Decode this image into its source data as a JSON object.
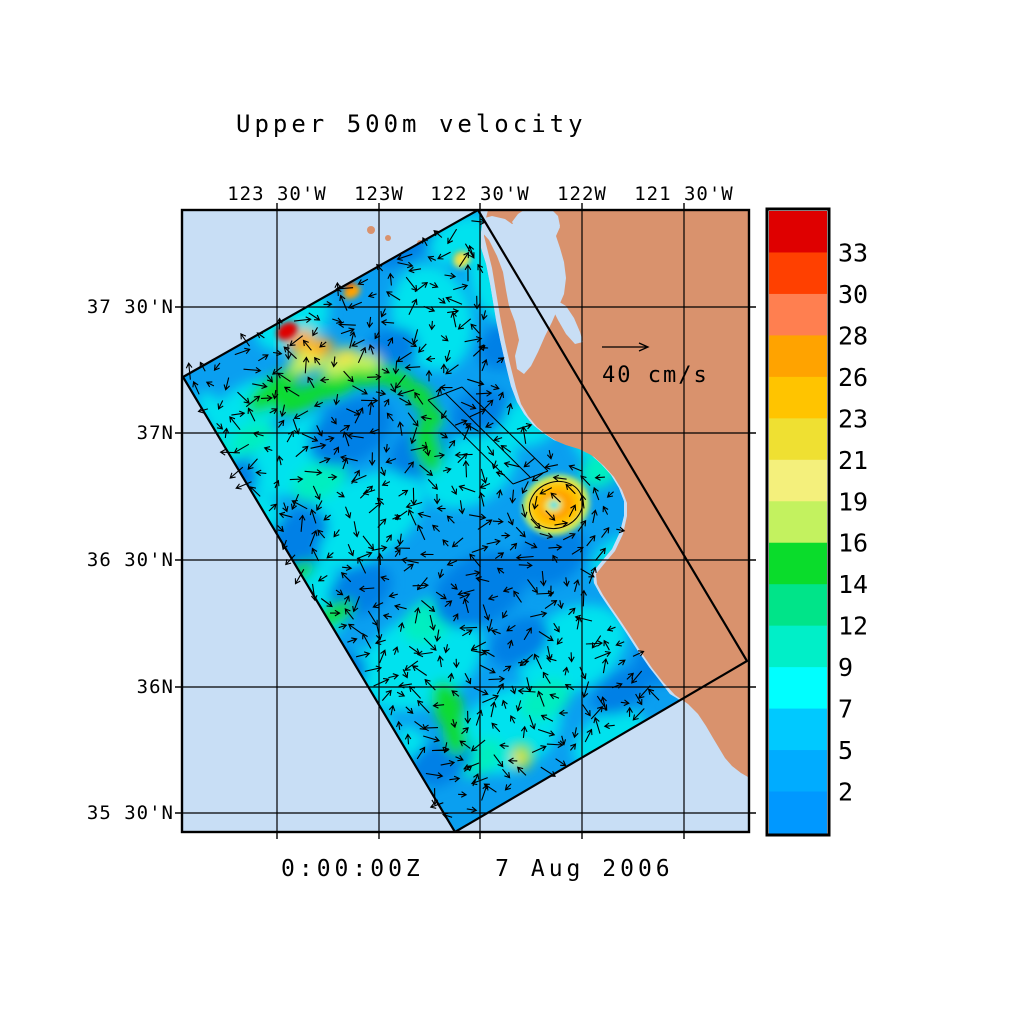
{
  "title": "Upper 500m velocity",
  "timestamp": "0:00:00Z    7 Aug 2006",
  "reference_vector": {
    "label": "40 cm/s"
  },
  "axis": {
    "top_labels": [
      {
        "text": "123 30'W",
        "x": 277
      },
      {
        "text": "123W",
        "x": 379
      },
      {
        "text": "122 30'W",
        "x": 480
      },
      {
        "text": "122W",
        "x": 582
      },
      {
        "text": "121 30'W",
        "x": 684
      }
    ],
    "left_labels": [
      {
        "text": "37 30'N",
        "y": 307
      },
      {
        "text": "37N",
        "y": 433
      },
      {
        "text": "36 30'N",
        "y": 560
      },
      {
        "text": "36N",
        "y": 687
      },
      {
        "text": "35 30'N",
        "y": 813
      }
    ]
  },
  "colorbar": {
    "labels_top_to_bottom": [
      "33",
      "30",
      "28",
      "26",
      "23",
      "21",
      "19",
      "16",
      "14",
      "12",
      "9",
      "7",
      "5",
      "2"
    ],
    "colors_top_to_bottom": [
      "#DF0000",
      "#FF4000",
      "#FF7F50",
      "#FFA300",
      "#FFC400",
      "#EFE032",
      "#F4F07C",
      "#C3F25F",
      "#0ADC2B",
      "#00E489",
      "#00EFC8",
      "#00FFFF",
      "#00C9FF",
      "#00ACFF",
      "#0098FF"
    ]
  },
  "palette": {
    "ocean": "#C8DEF5",
    "land": "#D9926D",
    "base": "#0A9FF0",
    "ink": "#000000",
    "b": "#0080E6",
    "c": "#00E2EE",
    "t": "#00EFC0",
    "g": "#0ADC32",
    "lg": "#C3F25F",
    "y": "#EFE44A",
    "am": "#FFC400",
    "o": "#FFA300",
    "r": "#E00000"
  },
  "chart_data": {
    "type": "heatmap",
    "title": "Upper 500m velocity",
    "datetime": "0:00:00Z 7 Aug 2006",
    "units": "cm/s",
    "x_ticks": [
      "123 30'W",
      "123W",
      "122 30'W",
      "122W",
      "121 30'W"
    ],
    "y_ticks": [
      "37 30'N",
      "37N",
      "36 30'N",
      "36N",
      "35 30'N"
    ],
    "x_range_deg_west": [
      123.97,
      121.18
    ],
    "y_range_deg_north": [
      35.43,
      37.88
    ],
    "colorbar_boundaries_cm_s": [
      2,
      5,
      7,
      9,
      12,
      14,
      16,
      19,
      21,
      23,
      26,
      28,
      30,
      33
    ],
    "reference_vector_cm_s": 40,
    "legend_position": "right",
    "grid": true,
    "features": [
      {
        "name": "model-domain",
        "shape": "rotated rectangle outlined in black, tilted ~30 deg, spanning the coastal ocean"
      },
      {
        "name": "high-speed-jet",
        "location": "northwest corner of domain near 123.5W 37.3N",
        "max_cm_s": 33
      },
      {
        "name": "coastal-eddy",
        "location": "off Monterey Bay near 122.1W 36.7N",
        "ring_speed_cm_s": 26
      },
      {
        "name": "background-flow",
        "typical_cm_s": "2-9"
      }
    ]
  },
  "geometry": {
    "frame": {
      "x": 182,
      "y": 210,
      "w": 567,
      "h": 622
    },
    "lon_x": [
      277,
      379,
      480,
      582,
      684
    ],
    "lat_y": [
      307,
      433,
      560,
      687,
      813
    ],
    "domain": [
      [
        478,
        210
      ],
      [
        747,
        661
      ],
      [
        455,
        832
      ],
      [
        183,
        377
      ]
    ],
    "field": [
      [
        183,
        377
      ],
      [
        478,
        210
      ],
      [
        483,
        219
      ],
      [
        481,
        232
      ],
      [
        481,
        248
      ],
      [
        486,
        264
      ],
      [
        490,
        284
      ],
      [
        493,
        302
      ],
      [
        496,
        320
      ],
      [
        500,
        340
      ],
      [
        505,
        362
      ],
      [
        511,
        386
      ],
      [
        517,
        402
      ],
      [
        524,
        414
      ],
      [
        533,
        425
      ],
      [
        543,
        433
      ],
      [
        554,
        440
      ],
      [
        566,
        445
      ],
      [
        579,
        449
      ],
      [
        591,
        455
      ],
      [
        601,
        464
      ],
      [
        611,
        475
      ],
      [
        619,
        488
      ],
      [
        624,
        501
      ],
      [
        624,
        516
      ],
      [
        620,
        532
      ],
      [
        612,
        549
      ],
      [
        601,
        562
      ],
      [
        593,
        572
      ],
      [
        594,
        583
      ],
      [
        600,
        594
      ],
      [
        608,
        606
      ],
      [
        617,
        619
      ],
      [
        627,
        634
      ],
      [
        638,
        651
      ],
      [
        649,
        667
      ],
      [
        660,
        681
      ],
      [
        670,
        694
      ],
      [
        680,
        700
      ],
      [
        455,
        832
      ]
    ],
    "land": [
      [
        488,
        210
      ],
      [
        485,
        222
      ],
      [
        484,
        236
      ],
      [
        488,
        252
      ],
      [
        492,
        268
      ],
      [
        495,
        286
      ],
      [
        498,
        304
      ],
      [
        501,
        322
      ],
      [
        505,
        342
      ],
      [
        510,
        364
      ],
      [
        516,
        388
      ],
      [
        521,
        404
      ],
      [
        528,
        416
      ],
      [
        537,
        427
      ],
      [
        547,
        435
      ],
      [
        558,
        442
      ],
      [
        570,
        447
      ],
      [
        583,
        451
      ],
      [
        594,
        457
      ],
      [
        604,
        466
      ],
      [
        614,
        477
      ],
      [
        622,
        490
      ],
      [
        627,
        503
      ],
      [
        627,
        516
      ],
      [
        623,
        534
      ],
      [
        615,
        551
      ],
      [
        604,
        564
      ],
      [
        596,
        574
      ],
      [
        597,
        584
      ],
      [
        603,
        595
      ],
      [
        611,
        607
      ],
      [
        620,
        620
      ],
      [
        630,
        635
      ],
      [
        641,
        652
      ],
      [
        652,
        668
      ],
      [
        663,
        682
      ],
      [
        675,
        695
      ],
      [
        688,
        704
      ],
      [
        698,
        714
      ],
      [
        706,
        726
      ],
      [
        713,
        738
      ],
      [
        719,
        748
      ],
      [
        725,
        758
      ],
      [
        732,
        766
      ],
      [
        741,
        773
      ],
      [
        748,
        777
      ],
      [
        749,
        777
      ],
      [
        749,
        210
      ]
    ],
    "bays": [
      [
        [
          481,
          219
        ],
        [
          492,
          216
        ],
        [
          505,
          219
        ],
        [
          512,
          224
        ],
        [
          520,
          221
        ],
        [
          532,
          216
        ],
        [
          546,
          214
        ],
        [
          556,
          218
        ],
        [
          560,
          227
        ],
        [
          556,
          236
        ],
        [
          560,
          248
        ],
        [
          564,
          262
        ],
        [
          566,
          278
        ],
        [
          564,
          294
        ],
        [
          558,
          308
        ],
        [
          552,
          322
        ],
        [
          545,
          336
        ],
        [
          538,
          352
        ],
        [
          531,
          366
        ],
        [
          524,
          374
        ],
        [
          517,
          369
        ],
        [
          515,
          356
        ],
        [
          519,
          340
        ],
        [
          515,
          322
        ],
        [
          509,
          306
        ],
        [
          506,
          290
        ],
        [
          503,
          272
        ],
        [
          497,
          256
        ],
        [
          489,
          240
        ],
        [
          480,
          230
        ]
      ],
      [
        [
          512,
          222
        ],
        [
          518,
          214
        ],
        [
          524,
          210
        ],
        [
          552,
          210
        ],
        [
          558,
          216
        ],
        [
          560,
          226
        ],
        [
          552,
          232
        ],
        [
          540,
          228
        ],
        [
          526,
          228
        ],
        [
          516,
          228
        ]
      ],
      [
        [
          556,
          300
        ],
        [
          566,
          306
        ],
        [
          574,
          318
        ],
        [
          580,
          332
        ],
        [
          583,
          342
        ],
        [
          575,
          344
        ],
        [
          566,
          334
        ],
        [
          558,
          320
        ],
        [
          552,
          308
        ]
      ]
    ],
    "specks": [
      [
        371,
        230,
        4
      ],
      [
        388,
        238,
        3
      ],
      [
        420,
        243,
        3
      ]
    ],
    "nested_lines": [
      [
        428,
        400,
        513,
        484
      ],
      [
        445,
        393,
        530,
        477
      ],
      [
        462,
        387,
        548,
        471
      ],
      [
        428,
        400,
        462,
        387
      ],
      [
        513,
        484,
        548,
        471
      ]
    ],
    "eddy_ring": {
      "cx": 556,
      "cy": 505,
      "rx": 27,
      "ry": 23,
      "rot": -20
    },
    "blobs_soft": [
      [
        250,
        408,
        45,
        24,
        -30,
        "c"
      ],
      [
        302,
        455,
        60,
        34,
        -30,
        "c"
      ],
      [
        360,
        520,
        70,
        40,
        -30,
        "c"
      ],
      [
        300,
        612,
        55,
        40,
        -30,
        "c"
      ],
      [
        422,
        660,
        65,
        45,
        -30,
        "c"
      ],
      [
        510,
        730,
        55,
        40,
        -30,
        "c"
      ],
      [
        572,
        650,
        58,
        40,
        -30,
        "c"
      ],
      [
        470,
        470,
        50,
        34,
        -30,
        "c"
      ],
      [
        432,
        318,
        40,
        54,
        -15,
        "c"
      ],
      [
        500,
        278,
        30,
        45,
        -15,
        "c"
      ],
      [
        610,
        430,
        40,
        24,
        -30,
        "c"
      ],
      [
        232,
        520,
        34,
        26,
        -30,
        "c"
      ],
      [
        352,
        742,
        45,
        26,
        -30,
        "c"
      ],
      [
        610,
        740,
        40,
        26,
        -30,
        "c"
      ],
      [
        655,
        600,
        34,
        24,
        -30,
        "c"
      ],
      [
        292,
        320,
        40,
        28,
        -30,
        "c"
      ],
      [
        462,
        240,
        34,
        22,
        -25,
        "c"
      ],
      [
        532,
        420,
        34,
        24,
        -30,
        "c"
      ],
      [
        620,
        560,
        30,
        22,
        -30,
        "c"
      ],
      [
        262,
        670,
        34,
        24,
        -30,
        "c"
      ],
      [
        392,
        798,
        40,
        20,
        -30,
        "c"
      ],
      [
        322,
        594,
        34,
        15,
        59,
        "c"
      ],
      [
        372,
        678,
        34,
        15,
        59,
        "c"
      ],
      [
        420,
        756,
        34,
        15,
        59,
        "c"
      ],
      [
        272,
        520,
        28,
        13,
        59,
        "c"
      ],
      [
        228,
        445,
        24,
        12,
        59,
        "c"
      ],
      [
        212,
        410,
        20,
        11,
        59,
        "c"
      ],
      [
        320,
        480,
        30,
        18,
        -30,
        "t"
      ],
      [
        430,
        620,
        30,
        20,
        -30,
        "t"
      ],
      [
        545,
        700,
        28,
        18,
        -30,
        "t"
      ],
      [
        480,
        758,
        26,
        16,
        -30,
        "t"
      ],
      [
        600,
        470,
        22,
        16,
        -30,
        "t"
      ],
      [
        252,
        438,
        24,
        14,
        -30,
        "t"
      ],
      [
        350,
        432,
        45,
        30,
        -30,
        "b"
      ],
      [
        480,
        590,
        50,
        34,
        -30,
        "b"
      ],
      [
        282,
        560,
        40,
        30,
        -30,
        "b"
      ],
      [
        550,
        556,
        38,
        28,
        -30,
        "b"
      ],
      [
        400,
        240,
        34,
        24,
        -30,
        "b"
      ],
      [
        330,
        680,
        40,
        26,
        -30,
        "b"
      ],
      [
        440,
        762,
        36,
        22,
        -30,
        "b"
      ],
      [
        662,
        660,
        30,
        22,
        -30,
        "b"
      ],
      [
        575,
        390,
        34,
        24,
        -30,
        "b"
      ],
      [
        506,
        345,
        30,
        22,
        -30,
        "b"
      ],
      [
        620,
        692,
        30,
        20,
        -30,
        "b"
      ],
      [
        232,
        482,
        28,
        20,
        -30,
        "b"
      ],
      [
        300,
        532,
        30,
        22,
        -30,
        "b"
      ],
      [
        420,
        452,
        32,
        24,
        -30,
        "b"
      ],
      [
        520,
        642,
        32,
        22,
        -30,
        "b"
      ],
      [
        480,
        412,
        30,
        22,
        -30,
        "b"
      ],
      [
        390,
        352,
        30,
        22,
        -30,
        "b"
      ],
      [
        360,
        590,
        34,
        24,
        -30,
        "b"
      ],
      [
        272,
        392,
        30,
        13,
        -38,
        "g"
      ],
      [
        300,
        400,
        26,
        12,
        -22,
        "g"
      ],
      [
        330,
        388,
        24,
        11,
        -8,
        "g"
      ],
      [
        362,
        376,
        22,
        11,
        4,
        "g"
      ],
      [
        395,
        378,
        20,
        11,
        22,
        "g"
      ],
      [
        420,
        396,
        16,
        11,
        45,
        "g"
      ],
      [
        432,
        418,
        13,
        11,
        60,
        "g"
      ],
      [
        205,
        452,
        16,
        26,
        -28,
        "g"
      ],
      [
        428,
        448,
        13,
        26,
        -15,
        "g"
      ],
      [
        660,
        492,
        14,
        28,
        -12,
        "g"
      ],
      [
        668,
        524,
        11,
        20,
        -5,
        "g"
      ],
      [
        448,
        706,
        15,
        26,
        -18,
        "g"
      ],
      [
        455,
        736,
        12,
        20,
        -8,
        "g"
      ],
      [
        232,
        645,
        12,
        18,
        -30,
        "g"
      ],
      [
        296,
        702,
        11,
        15,
        -30,
        "g"
      ],
      [
        522,
        756,
        11,
        14,
        -10,
        "g"
      ],
      [
        560,
        356,
        10,
        15,
        -20,
        "g"
      ],
      [
        333,
        615,
        10,
        24,
        59,
        "g"
      ],
      [
        300,
        572,
        8,
        16,
        59,
        "g"
      ],
      [
        308,
        360,
        22,
        12,
        -30,
        "lg"
      ],
      [
        338,
        366,
        18,
        10,
        -16,
        "lg"
      ],
      [
        366,
        362,
        15,
        9,
        0,
        "lg"
      ],
      [
        315,
        350,
        18,
        10,
        -30,
        "y"
      ],
      [
        345,
        356,
        14,
        8,
        -14,
        "y"
      ],
      [
        520,
        758,
        7,
        9,
        0,
        "y"
      ],
      [
        300,
        340,
        15,
        9,
        -30,
        "o"
      ],
      [
        322,
        347,
        12,
        8,
        -18,
        "o"
      ]
    ],
    "blobs_sharp": [
      [
        287,
        331,
        11,
        8,
        -32,
        "r"
      ],
      [
        350,
        287,
        6,
        5,
        -30,
        "r"
      ],
      [
        352,
        292,
        9,
        6,
        -30,
        "o"
      ],
      [
        460,
        257,
        7,
        5,
        -35,
        "o"
      ],
      [
        462,
        260,
        9,
        7,
        -35,
        "y"
      ],
      [
        556,
        505,
        34,
        30,
        -20,
        "lg"
      ],
      [
        556,
        505,
        28,
        24,
        -20,
        "am"
      ],
      [
        556,
        505,
        18,
        15,
        -20,
        "o"
      ],
      [
        553,
        505,
        10,
        8,
        -20,
        "y"
      ],
      [
        554,
        505,
        5,
        4,
        0,
        "c"
      ]
    ],
    "coast_x_by_y": [
      [
        210,
        483
      ],
      [
        250,
        489
      ],
      [
        300,
        497
      ],
      [
        350,
        505
      ],
      [
        390,
        516
      ],
      [
        420,
        528
      ],
      [
        440,
        545
      ],
      [
        450,
        560
      ],
      [
        455,
        575
      ],
      [
        460,
        595
      ],
      [
        470,
        612
      ],
      [
        490,
        622
      ],
      [
        510,
        627
      ],
      [
        535,
        625
      ],
      [
        555,
        617
      ],
      [
        575,
        600
      ],
      [
        590,
        597
      ],
      [
        610,
        612
      ],
      [
        640,
        636
      ],
      [
        670,
        662
      ],
      [
        700,
        688
      ],
      [
        730,
        714
      ],
      [
        760,
        726
      ],
      [
        790,
        741
      ],
      [
        832,
        745
      ]
    ],
    "vectors": {
      "origin": [
        183,
        377
      ],
      "e1": [
        0.87,
        -0.492
      ],
      "e2": [
        0.513,
        0.858
      ],
      "du": 17,
      "dv": 17,
      "nu": 20,
      "nv": 31,
      "eddy": [
        556,
        505,
        52
      ]
    },
    "ref_arrow": {
      "x1": 602,
      "y1": 347,
      "x2": 648,
      "y2": 347,
      "tx": 602,
      "ty": 382
    },
    "cbar": {
      "x": 767,
      "y": 209,
      "w": 62,
      "h": 626,
      "label_x": 838
    }
  }
}
